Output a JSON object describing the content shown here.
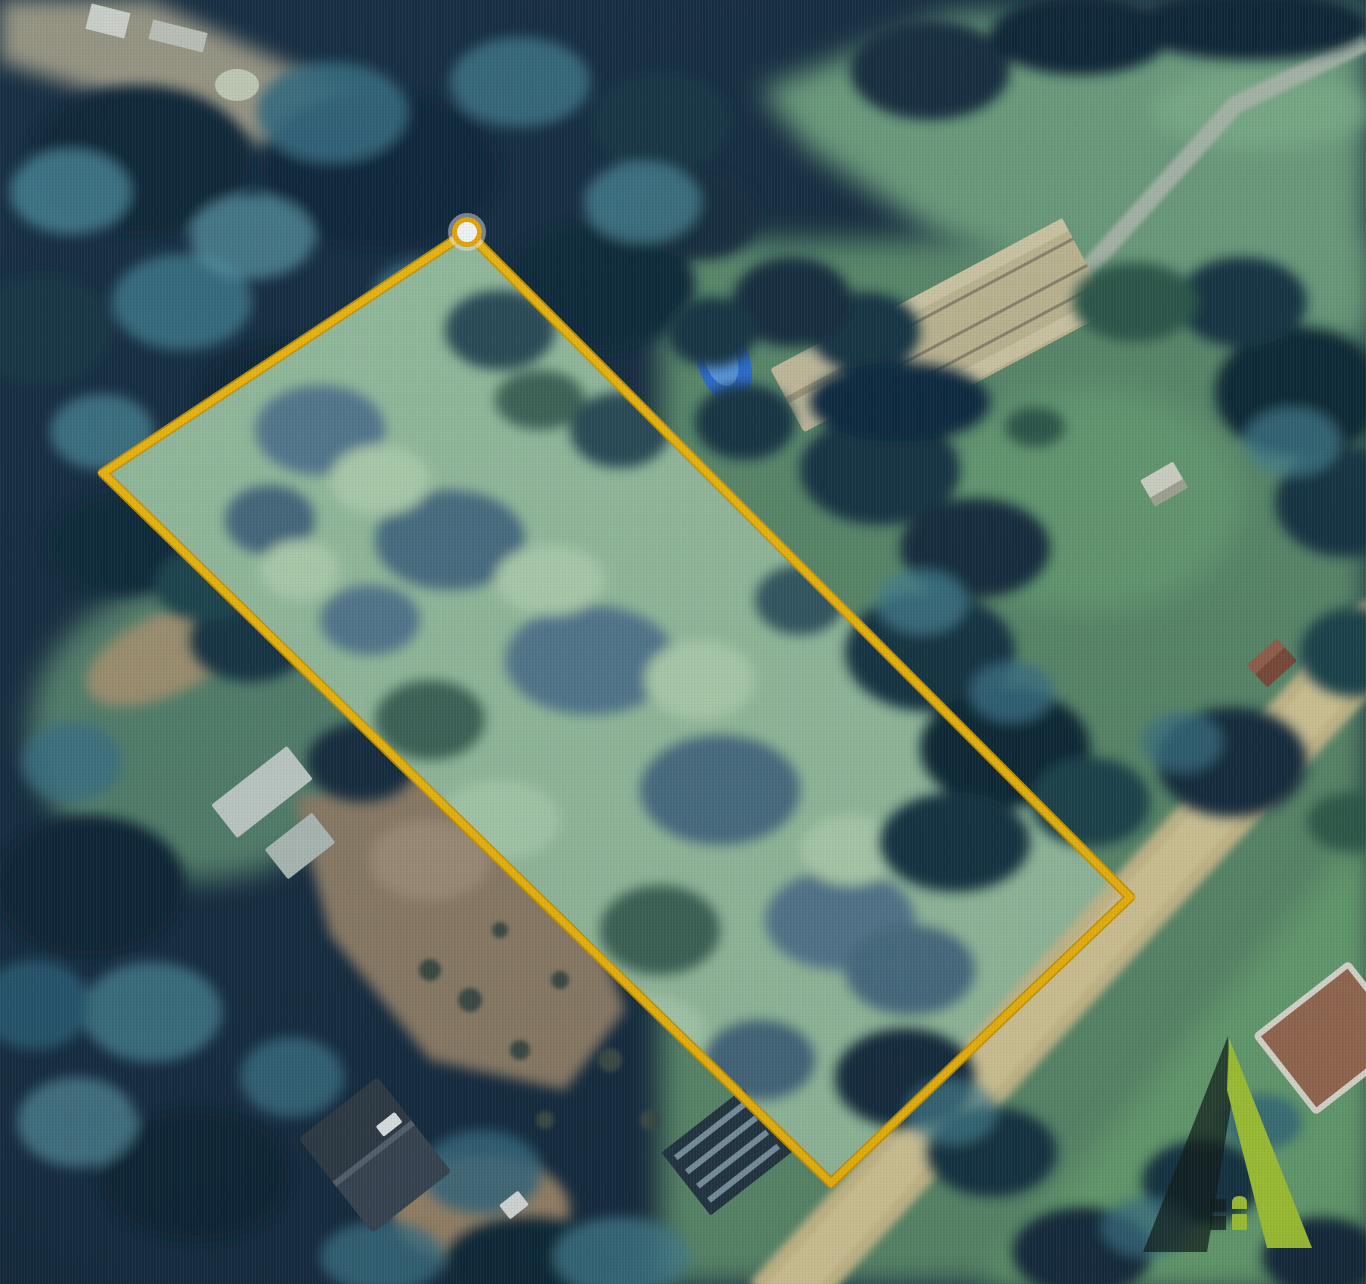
{
  "scene": {
    "type": "satellite aerial photograph",
    "subject": "rural land parcel outlined with a yellow property boundary",
    "visible_text": ""
  },
  "map": {
    "boundary": {
      "shape": "quadrilateral",
      "points": "467,232 1130,897 831,1183 103,473",
      "vertex_marker": {
        "x": 467,
        "y": 232
      }
    },
    "watermark": {
      "icon": "a-frame-house-logo"
    }
  },
  "theme": {
    "boundary": "#f5ba0c",
    "boundary-under": "#cf9704",
    "marker-fill": "#ffffff",
    "marker-ring": "#efa808",
    "logo-accent": "#a9c938",
    "logo-shadow": "rgba(17,27,22,0.72)"
  }
}
